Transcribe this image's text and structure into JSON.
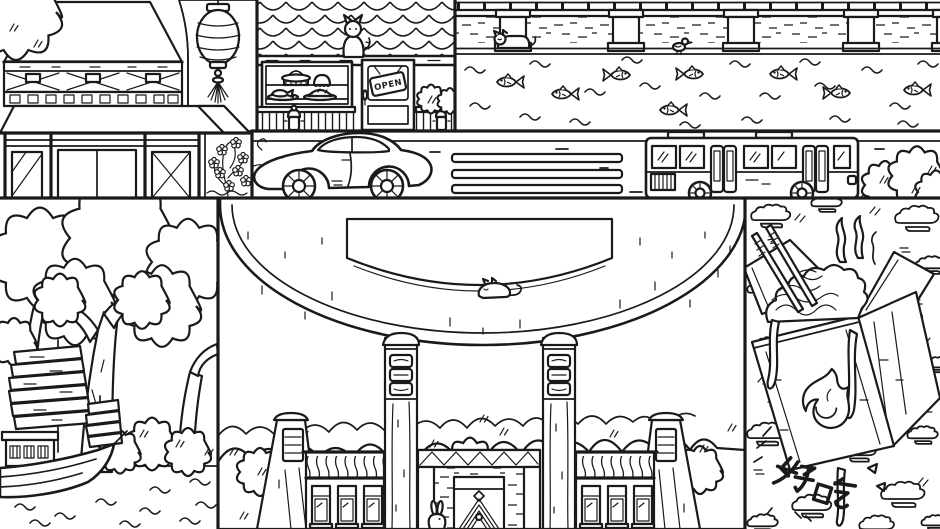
{
  "canvas": {
    "width": 940,
    "height": 529,
    "description": "Black-and-white line-art illustration of a Chinese town: pavilion with hanging lantern, bakery storefront, canal with fish, street with sports car and city bus, park with trees and junk boat, large brick-arch gate with hedges, and a noodle takeout box"
  },
  "palette": {
    "ink": "#1a1a1a",
    "paper": "#ffffff"
  },
  "panels": {
    "pavilion": {
      "name": "pavilion with hanging lantern",
      "icons": [
        "lantern-icon",
        "flower-vine-icon",
        "tree-icon"
      ]
    },
    "bakery": {
      "open_sign": "OPEN",
      "name": "bakery storefront",
      "icons": [
        "cat-icon",
        "steamer-icon",
        "pudding-icon",
        "fish-dish-icon",
        "pie-icon",
        "hydrant-icon",
        "bush-icon"
      ]
    },
    "canal": {
      "name": "canal with fish",
      "fish_count": 8,
      "icons": [
        "cat-icon",
        "bird-icon",
        "wave-icon"
      ]
    },
    "road": {
      "name": "street",
      "crosswalk_bars": 3,
      "icons": [
        "sports-car-icon",
        "city-bus-icon",
        "bush-icon"
      ]
    },
    "park": {
      "name": "park with junk boat",
      "icons": [
        "tree-icon",
        "junk-boat-icon",
        "wave-icon",
        "bush-icon"
      ]
    },
    "gate": {
      "name": "gate with brick arch",
      "icons": [
        "sleeping-cat-icon",
        "rabbit-icon",
        "plaque-icon",
        "hedge-icon"
      ]
    },
    "noodles": {
      "tasty_label": "好吃",
      "name": "noodle takeout box",
      "icons": [
        "chopsticks-icon",
        "flame-icon",
        "cloud-icon",
        "steam-icon"
      ]
    }
  }
}
